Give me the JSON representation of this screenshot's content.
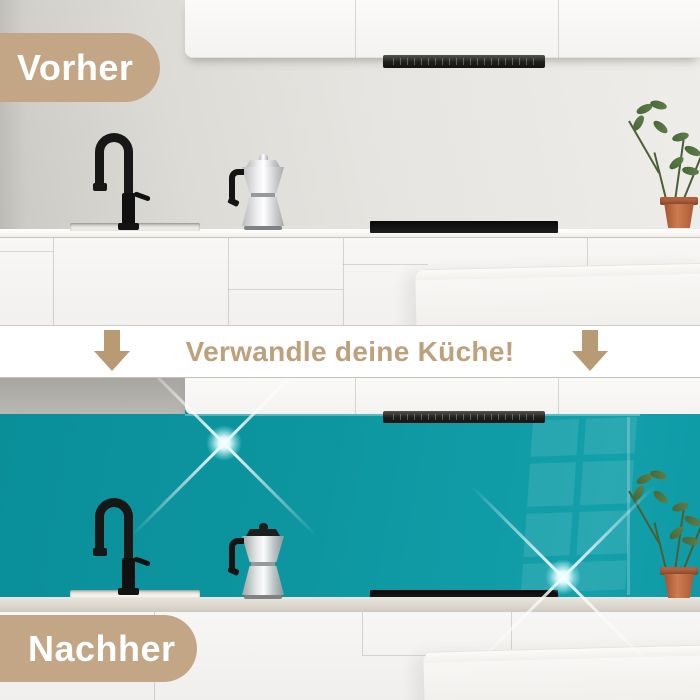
{
  "comparison": {
    "before_label": "Vorher",
    "after_label": "Nachher",
    "banner_text": "Verwandle deine Küche!"
  },
  "icons": {
    "down_arrow": "↓",
    "sparkle": "✦"
  },
  "colors": {
    "badge_tan": "#c3a685",
    "banner_text_tan": "#bda07c",
    "arrow_tan": "#b89a75",
    "backsplash_teal": "#0d96a0",
    "banner_bg": "#ffffff"
  }
}
